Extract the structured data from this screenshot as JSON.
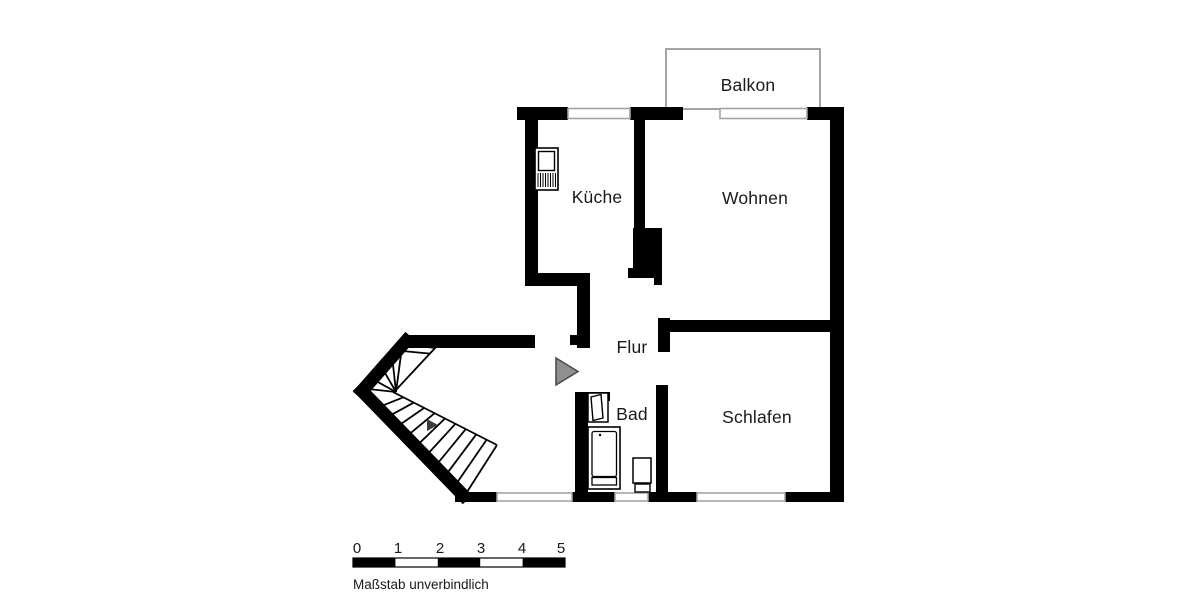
{
  "plan": {
    "name": "apartment-floor-plan",
    "rooms": [
      {
        "id": "balkon",
        "label": "Balkon"
      },
      {
        "id": "kueche",
        "label": "Küche"
      },
      {
        "id": "wohnen",
        "label": "Wohnen"
      },
      {
        "id": "flur",
        "label": "Flur"
      },
      {
        "id": "bad",
        "label": "Bad"
      },
      {
        "id": "schlafen",
        "label": "Schlafen"
      }
    ],
    "fixtures": [
      "stairs",
      "entrance-arrow",
      "kitchen-appliance",
      "bath-door",
      "bathtub",
      "toilet"
    ]
  },
  "scale_bar": {
    "ticks": [
      "0",
      "1",
      "2",
      "3",
      "4",
      "5"
    ],
    "caption": "Maßstab unverbindlich"
  },
  "colors": {
    "wall": "#000000",
    "window_line": "#a3a3a3",
    "entrance_arrow_fill": "#8f8f8f",
    "entrance_arrow_stroke": "#4d4d4d",
    "text": "#1a1a1a",
    "background": "#ffffff"
  }
}
